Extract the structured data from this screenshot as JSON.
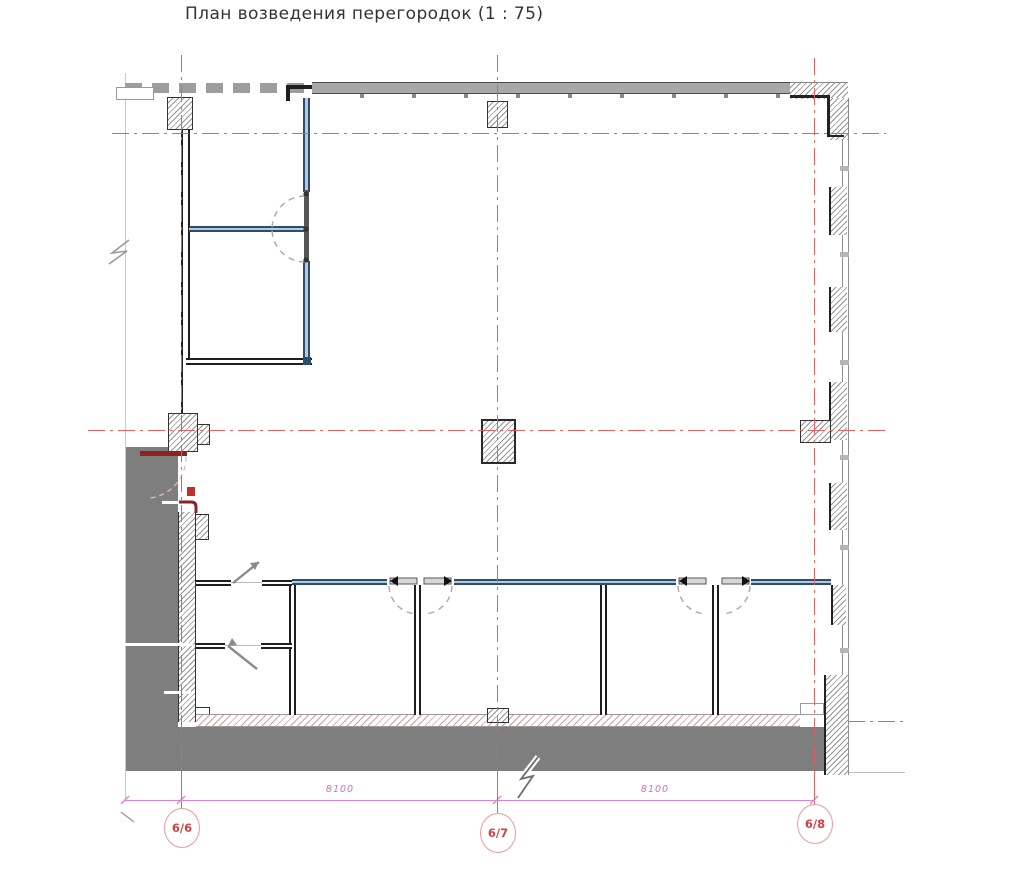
{
  "title": "План возведения перегородок (1 : 75)",
  "grid_axes": {
    "vertical": [
      {
        "label": "6/6"
      },
      {
        "label": "6/7"
      },
      {
        "label": "6/8"
      }
    ]
  },
  "dimensions": {
    "left": "8100",
    "right": "8100"
  },
  "colors": {
    "axis_red": "#e06262",
    "bubble_text_red": "#d14242",
    "dimension_magenta": "#c96fce",
    "partition_blue": "#2b4d70",
    "wall_gray": "#a6a6a6",
    "fill_gray": "#7e7e7e",
    "door_dark_red": "#8e2222",
    "outline_black": "#1f1f1f"
  }
}
